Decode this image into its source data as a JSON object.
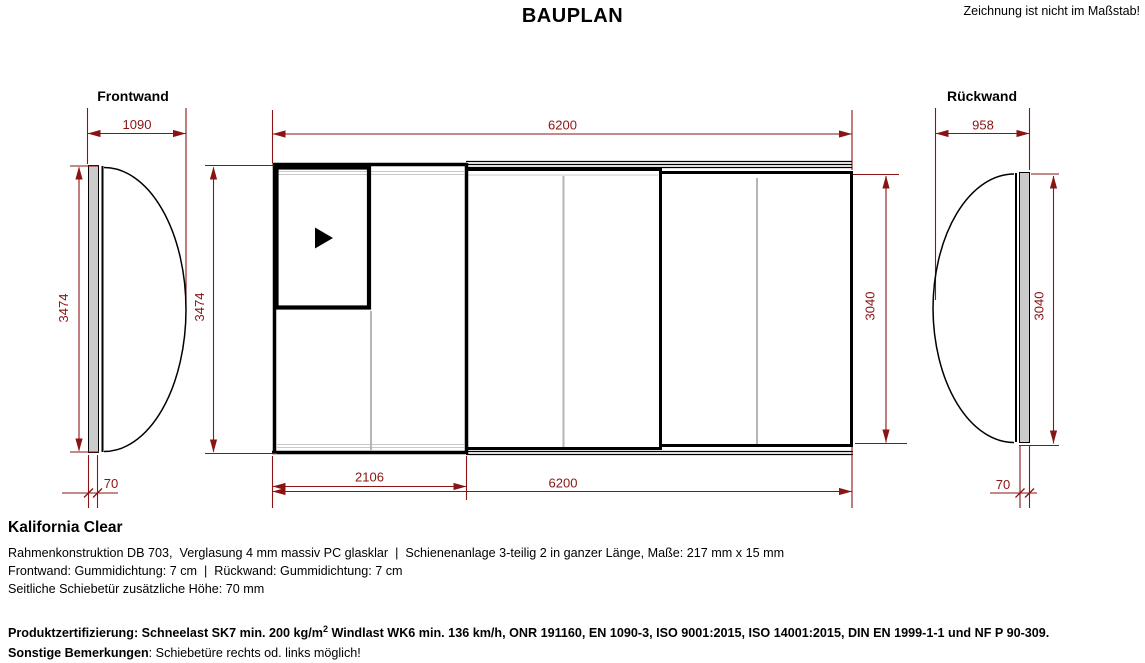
{
  "header": {
    "title": "BAUPLAN",
    "note": "Zeichnung ist nicht im Maßstab!"
  },
  "drawing": {
    "frontwand": {
      "label": "Frontwand",
      "dim_width": "1090",
      "dim_height": "3474",
      "dim_seal": "70"
    },
    "main": {
      "dim_top": "6200",
      "dim_left": "3474",
      "dim_right": "3040",
      "dim_door": "2106",
      "dim_bottom": "6200"
    },
    "rueckwand": {
      "label": "Rückwand",
      "dim_width": "958",
      "dim_height": "3040",
      "dim_seal": "70"
    },
    "colors": {
      "dimension": "#8a1414",
      "panel_fill": "#cbcbcb",
      "line": "#000000",
      "divider": "#b5b5b5"
    }
  },
  "details": {
    "product_name": "Kalifornia Clear",
    "line1": "Rahmenkonstruktion DB 703,  Verglasung 4 mm massiv PC glasklar  |  Schienenanlage 3-teilig 2 in ganzer Länge, Maße: 217 mm x 15 mm",
    "line2": "Frontwand: Gummidichtung: 7 cm  |  Rückwand: Gummidichtung: 7 cm",
    "line3": "Seitliche Schiebetür zusätzliche Höhe: 70 mm",
    "certification_label": "Produktzertifizierung:",
    "certification_before_sup": " Schneelast SK7 min. 200 kg/m",
    "certification_sup": "2",
    "certification_after_sup": " Windlast WK6 min. 136 km/h, ONR 191160, EN 1090-3, ISO 9001:2015, ISO 14001:2015, DIN EN 1999-1-1 und NF P 90-309.",
    "remarks_label": "Sonstige Bemerkungen",
    "remarks_text": ": Schiebetüre rechts od. links möglich!"
  }
}
